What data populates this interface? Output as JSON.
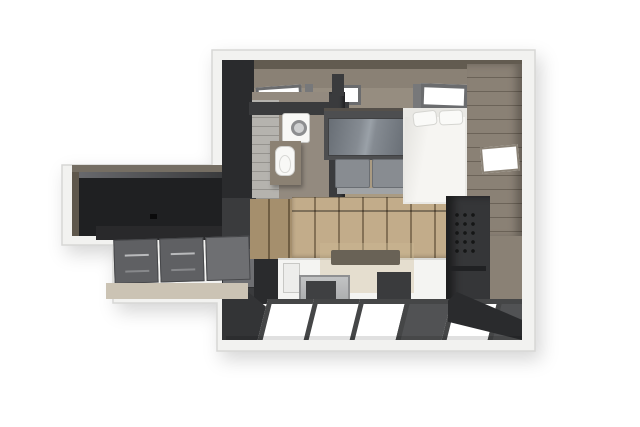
{
  "canvas": {
    "width": 640,
    "height": 427
  },
  "meta": {
    "type": "3d-floorplan-render",
    "description": "Top-down 3D cutaway rendering of a compact studio apartment: bathroom with washing machine and toilet, wood-front kitchen with island and cooktop, glass-top table, gray sofa, white bed, dark cabinet runs and glossy floor tiles"
  },
  "colors": {
    "bg": "#ffffff",
    "outline": "#d7d7d5",
    "band": "#f2f2f0",
    "wallTaupe": "#8a8175",
    "wallTaupeDark": "#625b50",
    "ceiling": "#968d80",
    "charcoal": "#3a3b3d",
    "charcoalDark": "#2a2b2d",
    "nearBlack": "#1f2022",
    "grayCab": "#5f6063",
    "grayCabLight": "#6e6f72",
    "glass": "#858b92",
    "glassEdge": "#686e75",
    "glassFrame": "#4d4e50",
    "sofa": "#888c91",
    "sofaLight": "#a0a3a6",
    "whiteSoft": "#f6f5f2",
    "pillow": "#fafaf8",
    "wood": "#c2ac8a",
    "woodDark": "#a58f6d",
    "woodFloor": "#aa9b82",
    "beigeFloor": "#cbc3b4",
    "steel": "#a6a8aa",
    "tileFrame": "#454647",
    "tileDark": "#515254",
    "skyFrame": "#6b6c6e",
    "post": "#77787a",
    "fixture": "#f8f8f6",
    "vanity": "#8b8173",
    "hoodGhost": "rgba(205,186,150,0.38)",
    "shadowLine": "rgba(0,0,0,0.12)",
    "stripePanel": "#b5b3ae"
  },
  "scene": {
    "areas": [
      {
        "name": "bathroom",
        "items": [
          "washing-machine",
          "toilet",
          "shower-wall-panel",
          "partition-wall"
        ]
      },
      {
        "name": "sleeping-area",
        "items": [
          "bed",
          "pillows",
          "east-wall-paneling",
          "window"
        ]
      },
      {
        "name": "living-area",
        "items": [
          "glass-top-table",
          "sofa",
          "skylights"
        ]
      },
      {
        "name": "kitchen",
        "items": [
          "wood-wall-cabinets",
          "cooktop",
          "extractor-hood-ghost",
          "island-counter",
          "microwave-oven",
          "island-cabinet",
          "tall-dark-unit"
        ]
      },
      {
        "name": "entry-wing",
        "items": [
          "dark-counter",
          "drawer-cabinets",
          "wing-floor"
        ]
      }
    ],
    "floor_tiles": [
      "white",
      "white",
      "white",
      "dark",
      "white",
      "dark"
    ]
  }
}
